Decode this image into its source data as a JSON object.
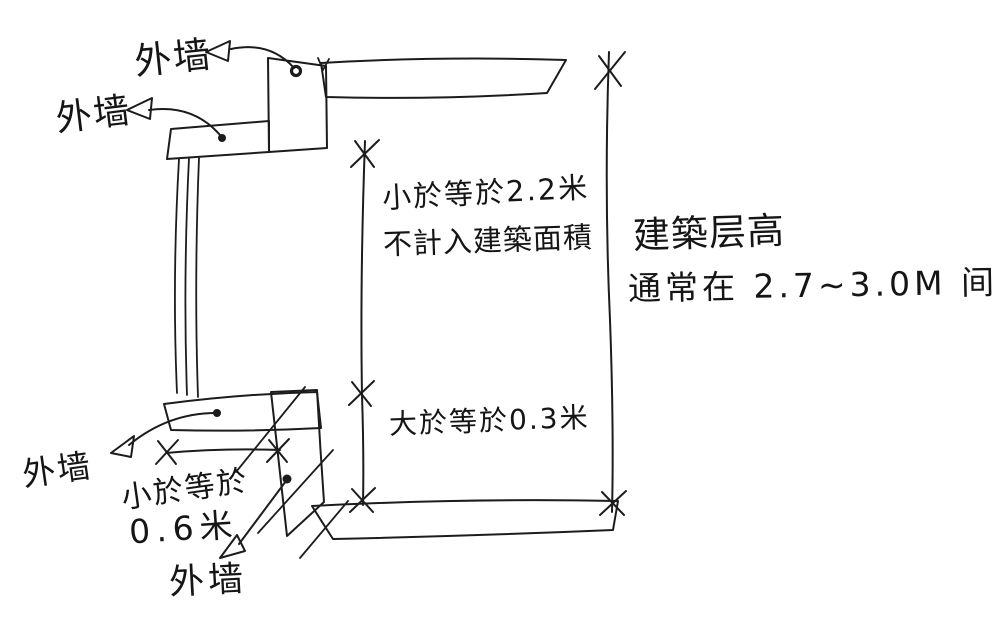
{
  "canvas": {
    "width": 1000,
    "height": 615,
    "background": "#ffffff",
    "ink_color": "#1c1c1c"
  },
  "wall_labels": {
    "top": "外墙",
    "middle": "外墙",
    "lower_left": "外墙",
    "bottom": "外墙"
  },
  "dimension_notes": {
    "upper_zone_line1": "小於等於2.2米",
    "upper_zone_line2": "不計入建築面積",
    "lower_zone": "大於等於0.3米",
    "overhang_line1": "小於等於",
    "overhang_line2": "0.6米"
  },
  "floor_height_note": {
    "line1": "建築层高",
    "line2": "通常在 2.7~3.0M 间"
  }
}
